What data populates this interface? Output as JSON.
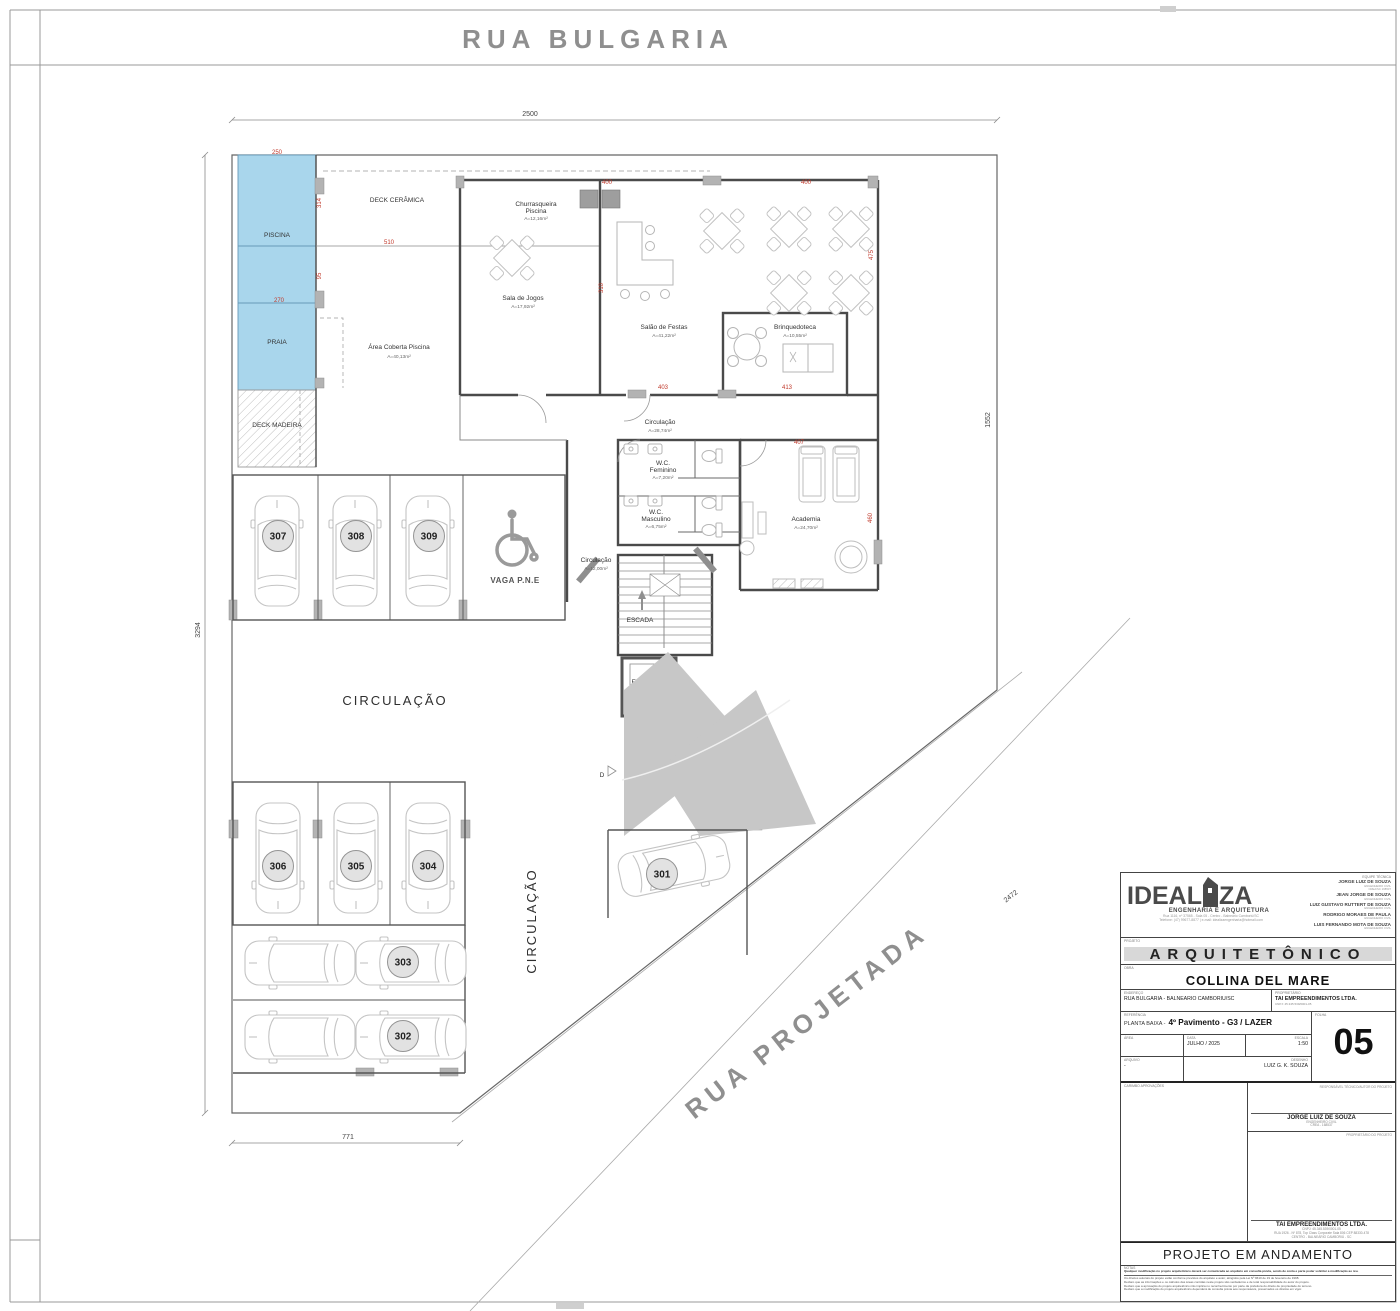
{
  "streets": {
    "top": "RUA  BULGARIA",
    "diagonal": "RUA  PROJETADA"
  },
  "dims": {
    "black": {
      "top": "2500",
      "left": "3294",
      "right": "1552",
      "bottom": "771",
      "diag": "2472"
    },
    "red": [
      "250",
      "314",
      "95",
      "270",
      "510",
      "400",
      "400",
      "475",
      "310",
      "403",
      "413",
      "407",
      "460"
    ]
  },
  "rooms": {
    "piscina": {
      "name": "PISCINA"
    },
    "praia": {
      "name": "PRAIA"
    },
    "deck_ceramica": {
      "name": "DECK CERÂMICA"
    },
    "deck_madeira": {
      "name": "DECK MADEIRA"
    },
    "area_coberta": {
      "name": "Área Coberta Piscina",
      "area": "A=40,13m²"
    },
    "churrasqueira": {
      "l1": "Churrasqueira",
      "l2": "Piscina",
      "area": "A=12,16m²"
    },
    "sala_jogos": {
      "name": "Sala de Jogos",
      "area": "A=17,92m²"
    },
    "salao_festas": {
      "name": "Salão de Festas",
      "area": "A=41,22m²"
    },
    "brinquedoteca": {
      "name": "Brinquedoteca",
      "area": "A=10,55m²"
    },
    "circulacao": {
      "name": "Circulação",
      "area": "A=28,74m²"
    },
    "wc_feminino": {
      "l1": "W.C.",
      "l2": "Feminino",
      "area": "A=7,20m²"
    },
    "wc_masculino": {
      "l1": "W.C.",
      "l2": "Masculino",
      "area": "A=6,75m²"
    },
    "circulacao2": {
      "name": "Circulação",
      "area": "A=12,00m²"
    },
    "academia": {
      "name": "Academia",
      "area": "A=24,70m²"
    },
    "escada": {
      "name": "ESCADA"
    },
    "elevador": {
      "name": "ELEVADOR",
      "area": "A=2,97m²"
    },
    "vaga_pne": {
      "name": "VAGA P.N.E"
    },
    "circulacao_garage": {
      "name": "CIRCULAÇÃO"
    },
    "circulacao_lane": {
      "name": "CIRCULAÇÃO"
    },
    "ramp_marker": "D"
  },
  "parking": {
    "spots": [
      "307",
      "308",
      "309",
      "306",
      "305",
      "304",
      "303",
      "302",
      "301"
    ]
  },
  "titleblock": {
    "logo": {
      "word_left": "IDEAL",
      "word_right": "ZA",
      "tagline": "ENGENHARIA E ARQUITETURA",
      "addr1": "Rua 1116, nº 37565 - Sala 05 - Centro - Balneário Camboriú/SC",
      "addr2": "Telefone: (47) 99677-8877 | e-mail: idealizaengenharia@hotmail.com"
    },
    "team": {
      "label": "EQUIPE TÉCNICA",
      "members": [
        {
          "name": "JORGE LUIZ DE SOUZA",
          "role": "ENGENHEIRO CIVIL",
          "reg": "CREA/SC 168537"
        },
        {
          "name": "JEAN JORGE DE SOUZA",
          "role": "ENGENHEIRO CIVIL",
          "reg": "CREA/SC"
        },
        {
          "name": "LUIZ GUSTAVO RUTTERT DE SOUZA",
          "role": "ENGENHEIRO CIVIL",
          "reg": "CREA/SC"
        },
        {
          "name": "RODRIGO MORAES DE PAULA",
          "role": "ENGENHEIRO CIVIL",
          "reg": "CREA/SC"
        },
        {
          "name": "LUIS FERNANDO MOTA DE SOUZA",
          "role": "ENGENHEIRO CIVIL",
          "reg": "CREA/SC"
        }
      ]
    },
    "projeto": {
      "label": "PROJETO",
      "value": "ARQUITETÔNICO"
    },
    "obra": {
      "label": "OBRA",
      "value": "COLLINA DEL MARE"
    },
    "endereco": {
      "label": "ENDEREÇO",
      "value": "RUA BULGARIA - BALNEARIO CAMBORIU/SC"
    },
    "proprietario": {
      "label": "PROPRIETÁRIO",
      "value": "TAI EMPREENDIMENTOS LTDA.",
      "sub": "CNPJ: 45.345.539/0001-05"
    },
    "referencia": {
      "label": "REFERÊNCIA",
      "prefix": "PLANTA BAIXA -",
      "value": "4º Pavimento - G3 / LAZER"
    },
    "area": {
      "label": "ÁREA",
      "value": ""
    },
    "data": {
      "label": "DATA",
      "value": "JULHO / 2025"
    },
    "escala": {
      "label": "ESCALA",
      "value": "1:50"
    },
    "arquivo": {
      "label": "ARQUIVO",
      "value": "-"
    },
    "desenho": {
      "label": "DESENHO",
      "value": "LUIZ G. K. SOUZA"
    },
    "folha": {
      "label": "FOLHA",
      "value": "05"
    },
    "carimbo": {
      "label": "CARIMBO APROVAÇÕES"
    },
    "responsavel": {
      "label": "RESPONSÁVEL TÉCNICO/AUTOR DO PROJETO",
      "name": "JORGE LUIZ DE SOUZA",
      "role": "ENGENHEIRO CIVIL",
      "reg": "CREA - 168537"
    },
    "dono": {
      "label": "PROPRIETÁRIO DO PROJETO",
      "name": "TAI EMPREENDIMENTOS LTDA.",
      "cnpj": "CNPJ: 45.345.539/0001-05",
      "addr1": "RUA 1926 - Nº 878, Top Class Corporate Sala 806 CEP 88330-478",
      "addr2": "CENTRO - BALNEÁRIO CAMBORIÚ - SC"
    },
    "status": "PROJETO EM ANDAMENTO",
    "notas": {
      "label": "NOTAS",
      "l1": "Qualquer modificação no projeto arquitetônico deverá ser comunicada ao arquiteto em consulta prévia, sendo de conta e parte poder solicitar a modificação ao réu.",
      "l2": "Os direitos autorais do projeto estão conforme previstos do arquiteto e autor, atingidos pela Lei Nº 9610 de 19 de fevereiro de 1998.",
      "l3": "Declaro que as informações e os cálculos das áreas contidas neste projeto são verdadeiros e de total responsabilidade do autor do projeto.",
      "l4": "Declaro que a aprovação do projeto arquitetônico não implica no reconhecimento por parte da prefeitura do direito de propriedade do terreno.",
      "l5": "Declaro que a modificação do projeto arquitetônico dependerá de consulta prévia aos responsáveis, preservados os direitos em vigor."
    }
  }
}
